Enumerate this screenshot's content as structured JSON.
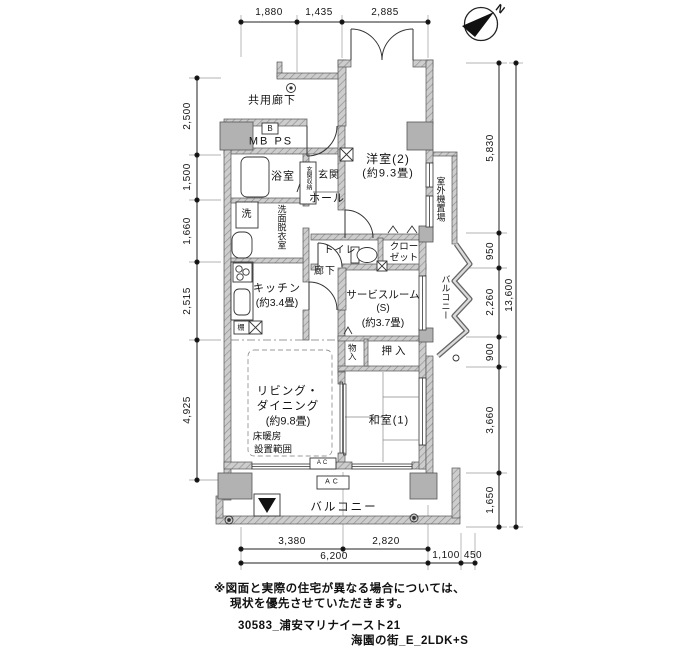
{
  "dims": {
    "top": [
      "1,880",
      "1,435",
      "2,885"
    ],
    "left": [
      "2,500",
      "1,500",
      "1,660",
      "2,515",
      "4,925"
    ],
    "right": [
      "5,830",
      "950",
      "2,260",
      "900",
      "3,660",
      "1,650"
    ],
    "right_total": "13,600",
    "bottom": [
      "3,380",
      "2,820",
      "6,200",
      "1,100",
      "450"
    ]
  },
  "labels": {
    "common_corridor": "共用廊下",
    "meter_b": "B",
    "mb_ps": "MB PS",
    "bathroom": "浴室",
    "entrance_storage": "玄関収納",
    "entrance": "玄関",
    "hall": "ホール",
    "washer": "洗",
    "washroom": "洗面脱衣室",
    "western2": "洋室(2)",
    "western2_size": "(約9.3畳)",
    "outdoor_unit": "室外機置場",
    "toilet": "トイレ",
    "closet1": "クロー",
    "closet2": "ゼット",
    "corridor": "廊下",
    "kitchen": "キッチン",
    "kitchen_size": "(約3.4畳)",
    "service": "サービスルーム",
    "service_s": "(S)",
    "service_size": "(約3.7畳)",
    "balcony_side": "バルコニー",
    "mono_ire": "物入",
    "oshiire": "押入",
    "living1": "リビング・",
    "living2": "ダイニング",
    "living_size": "(約9.8畳)",
    "floor_heat1": "床暖房",
    "floor_heat2": "設置範囲",
    "japanese1": "和室(1)",
    "shelf": "棚",
    "ac": "AC",
    "balcony_bottom": "バルコニー",
    "compass_n": "N"
  },
  "notes": {
    "line1": "※図面と実際の住宅が異なる場合については、",
    "line2": "現状を優先させていただきます。",
    "line3": "30583_浦安マリナイースト21",
    "line4": "海園の街_E_2LDK+S"
  },
  "colors": {
    "wall": "#c9c9c9",
    "pillar": "#b2b2b2",
    "line": "#222222",
    "bg": "#ffffff"
  }
}
